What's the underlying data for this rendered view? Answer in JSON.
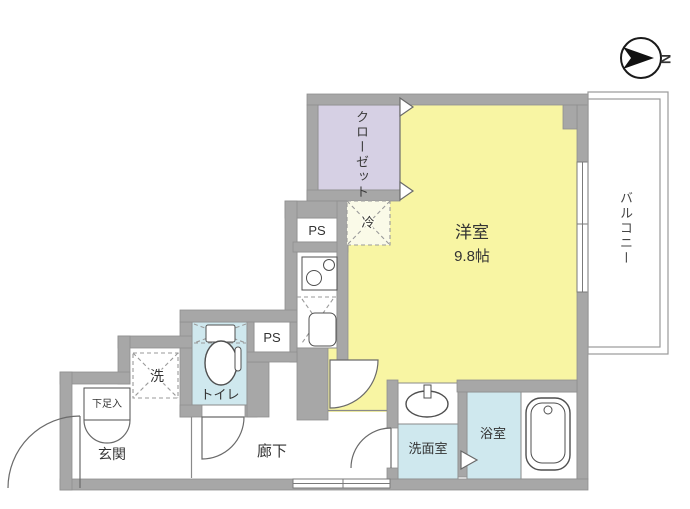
{
  "compass": {
    "north_label": "N"
  },
  "rooms": {
    "main": {
      "name": "洋室",
      "size": "9.8帖"
    },
    "closet": {
      "name": "クローゼット"
    },
    "balcony": {
      "name": "バルコニー"
    },
    "toilet": {
      "name": "トイレ"
    },
    "washroom": {
      "name": "洗面室"
    },
    "bathroom": {
      "name": "浴室"
    },
    "hallway": {
      "name": "廊下"
    },
    "entrance": {
      "name": "玄関"
    },
    "shoe_storage": {
      "name": "下足入"
    },
    "laundry": {
      "name": "洗"
    },
    "fridge": {
      "name": "冷"
    },
    "ps_upper": {
      "name": "PS"
    },
    "ps_lower": {
      "name": "PS"
    }
  },
  "colors": {
    "wall": "#a7a7a7",
    "wall_edge": "#8f8f8f",
    "room_yellow": "#f8f5a3",
    "closet_lavender": "#d6d0e4",
    "wet_cyan": "#cfe8ee",
    "fridge_pale": "#fafae8",
    "line_dark": "#4f4f4f",
    "thin_line": "#8a8a8a",
    "label": "#333333"
  }
}
